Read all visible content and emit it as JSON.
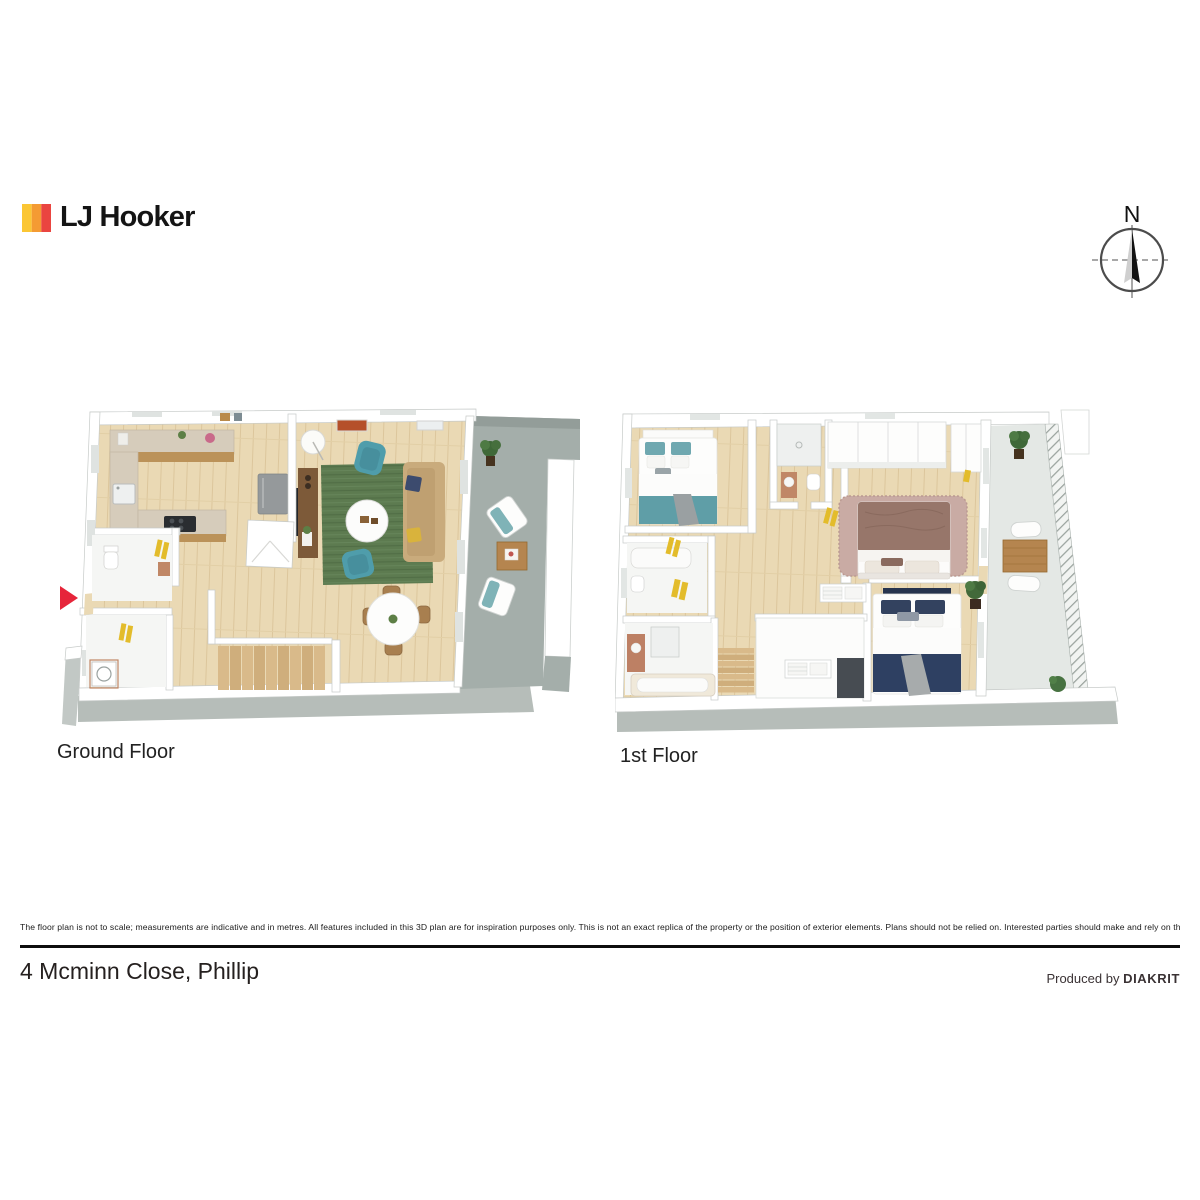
{
  "brand": {
    "name": "LJ Hooker",
    "logo_colors": [
      "#FBC634",
      "#F49B33",
      "#EA4540"
    ]
  },
  "compass": {
    "label": "N"
  },
  "plans": [
    {
      "id": "ground-floor",
      "label": "Ground Floor"
    },
    {
      "id": "first-floor",
      "label": "1st Floor"
    }
  ],
  "palette": {
    "timber_floor": "#ead9b4",
    "deck_gray": "#a4aeaa",
    "balcony_concrete": "#e4e8e5",
    "rug_green": "#5d7b50",
    "rug_mauve": "#c9aba4",
    "sofa_tan": "#c9ab7c",
    "armchair_teal": "#4f9dab",
    "bed_teal": "#5f9ea7",
    "bed_navy": "#2e4062",
    "bed_brown": "#97766a",
    "towel_yellow": "#e3bc2b",
    "outdoor_wood": "#b5854f",
    "entry_arrow_red": "#e6253a"
  },
  "footer": {
    "disclaimer": "The floor plan is not to scale; measurements are indicative and in metres. All features included in this 3D plan are for inspiration purposes only. This is not an exact replica of the property or the position of exterior elements. Plans should not be relied on. Interested parties should make and rely on their own enquiries.",
    "address": "4 Mcminn Close, Phillip",
    "produced_by": "Produced by",
    "producer": "DIAKRIT"
  }
}
